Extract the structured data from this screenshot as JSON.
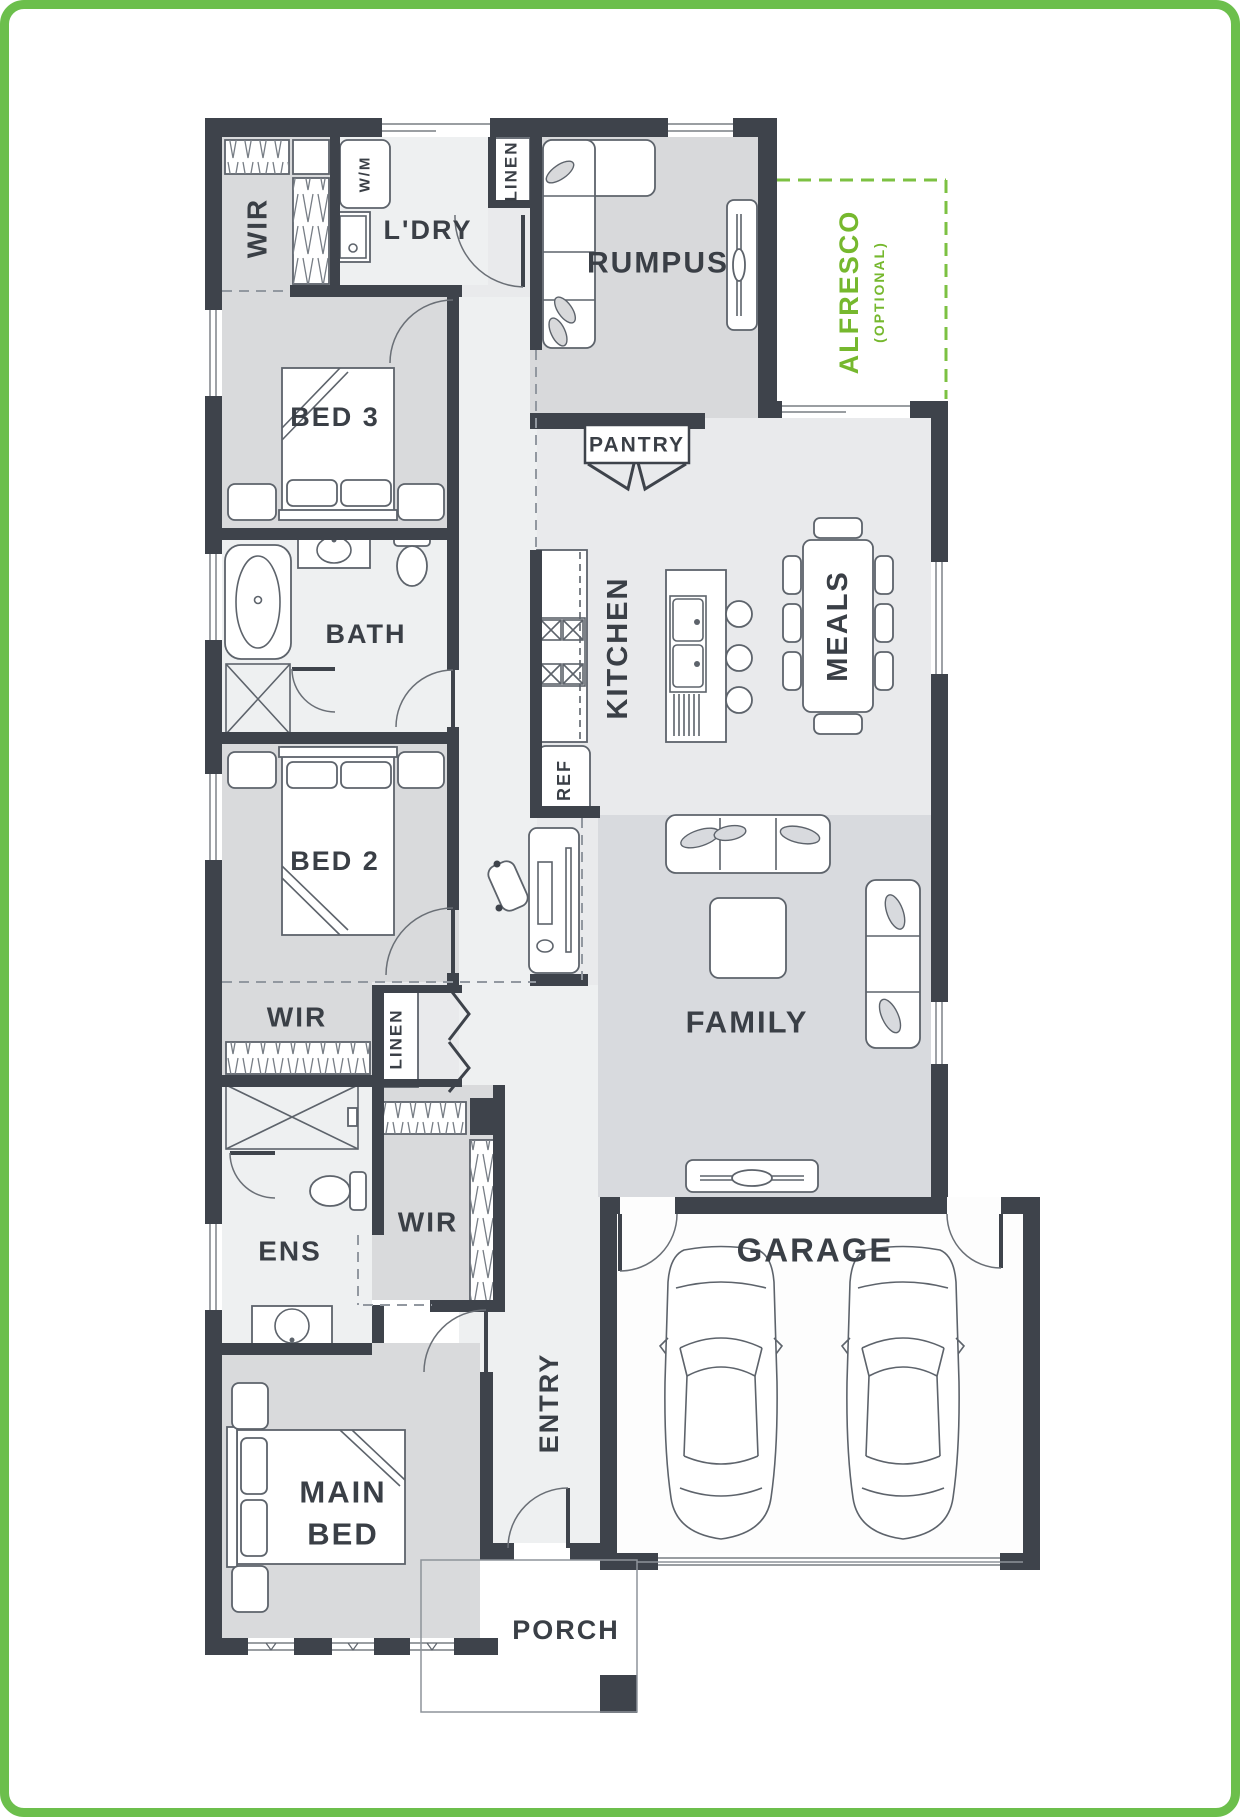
{
  "plan": {
    "colors": {
      "frame_green": "#6cbf4c",
      "alfresco_green": "#76b82e",
      "wall": "#3e434b",
      "label": "#3a3f46"
    },
    "labels": {
      "wir_top": "WIR",
      "laundry": "L'DRY",
      "washing_machine": "W/M",
      "linen_top": "LINEN",
      "rumpus": "RUMPUS",
      "alfresco": "ALFRESCO",
      "alfresco_option": "(OPTIONAL)",
      "bed3": "BED 3",
      "bath": "BATH",
      "pantry": "PANTRY",
      "kitchen": "KITCHEN",
      "meals": "MEALS",
      "bed2": "BED 2",
      "fridge": "REF",
      "wir_mid": "WIR",
      "linen_mid": "LINEN",
      "family": "FAMILY",
      "garage": "GARAGE",
      "ens": "ENS",
      "wir_main": "WIR",
      "entry": "ENTRY",
      "main_bed_line1": "MAIN",
      "main_bed_line2": "BED",
      "porch": "PORCH"
    }
  }
}
